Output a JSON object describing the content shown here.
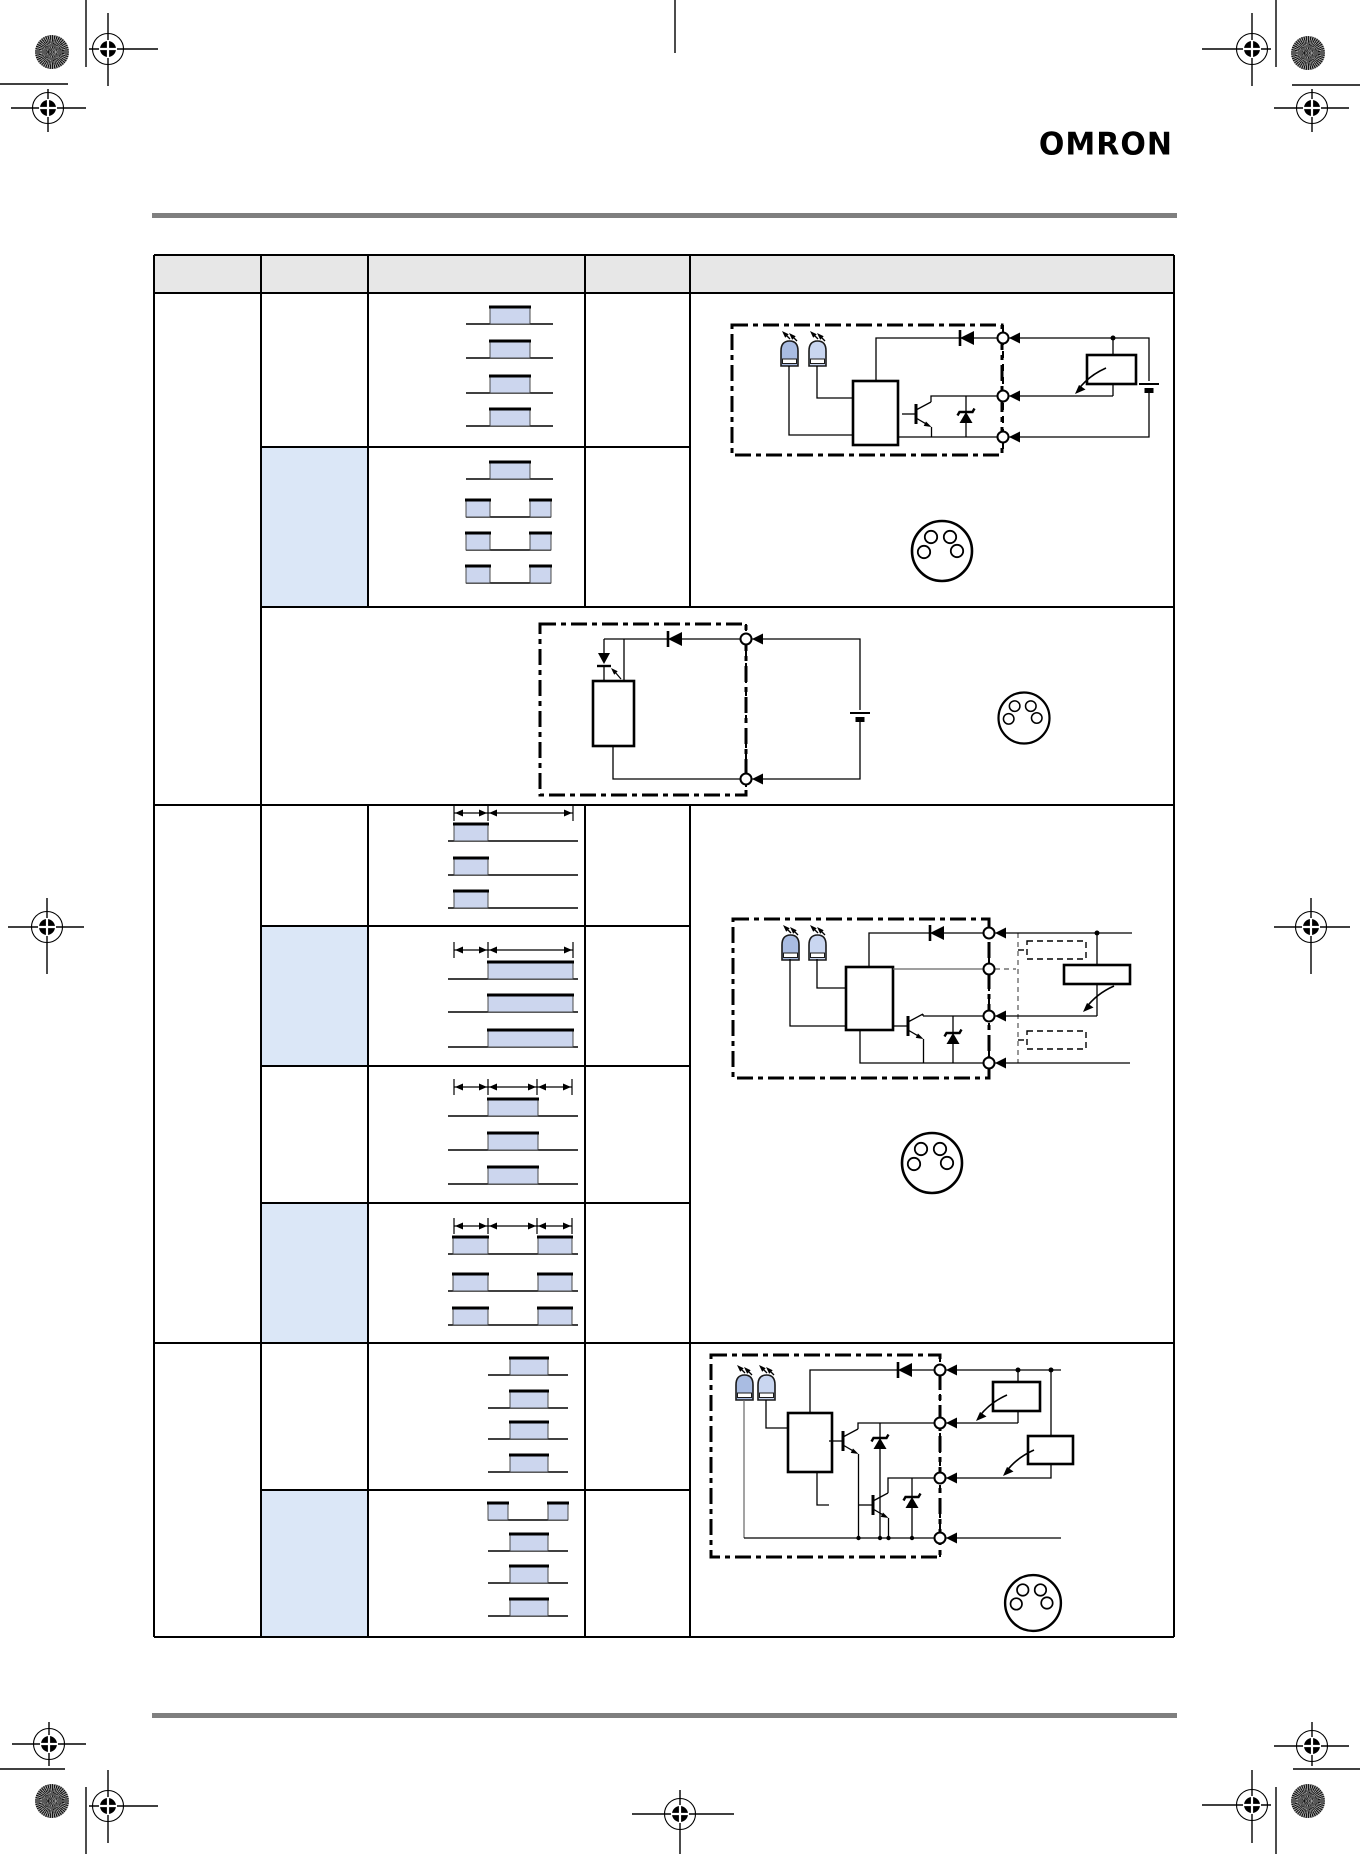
{
  "page": {
    "kind": "print-ready datasheet page",
    "background_color": "#ffffff",
    "logo_text": "OMRON",
    "rule_color": "#7f7f7f"
  },
  "table": {
    "header_fill": "#e7e7e7",
    "header_labels": [
      "",
      "",
      "",
      "",
      ""
    ],
    "row_highlight_fill": "#dbe7f7",
    "waveform_fill": "#ccd6ee",
    "waveform_edge_color": "#000000",
    "groups": [
      {
        "name": "group-1",
        "rows": [
          {
            "timing_pattern": "four single centered pulses",
            "highlighted": false
          },
          {
            "timing_pattern": "one centered pulse plus three complementary (high-low-high) traces",
            "highlighted": true
          },
          {
            "timing_pattern": "no waveform - circuit diagram row",
            "highlighted": false
          }
        ],
        "circuits": [
          "NPN open-collector output: sensor dash-dot box, 2 indicator LEDs, amplifier box, transistor, zener, reverse-protection diode, 3 terminals, external load and battery",
          "DC 2-wire output: dash-dot box, photo element, amplifier box, diode, 2 terminals, external battery"
        ]
      },
      {
        "name": "group-2",
        "rows": [
          {
            "timing_pattern": "short leading pulse with 2-segment dimension line",
            "highlighted": false
          },
          {
            "timing_pattern": "long trailing pulse with 2-segment dimension line",
            "highlighted": true
          },
          {
            "timing_pattern": "centered pulse with 3-segment dimension line",
            "highlighted": false
          },
          {
            "timing_pattern": "two separated pulses with 3-segment dimension line",
            "highlighted": true
          }
        ],
        "circuits": [
          "NPN open-collector output with dashed optional external blocks, wide load bar and 4 terminals"
        ]
      },
      {
        "name": "group-3",
        "rows": [
          {
            "timing_pattern": "four single centered pulses",
            "highlighted": false
          },
          {
            "timing_pattern": "one complementary trace plus three single pulses",
            "highlighted": true
          }
        ],
        "circuits": [
          "Dual NPN open-collector outputs: 2 transistors, 2 zeners, 2 external loads, 4 terminals"
        ]
      }
    ],
    "connector_icons": {
      "count": 4,
      "holes_per_connector": 4
    }
  },
  "print_marks": {
    "corner_sunburst_dots": 4,
    "registration_targets": 11,
    "edge_lines": "short crop lines at all four corners, top-center and bottom-center"
  }
}
